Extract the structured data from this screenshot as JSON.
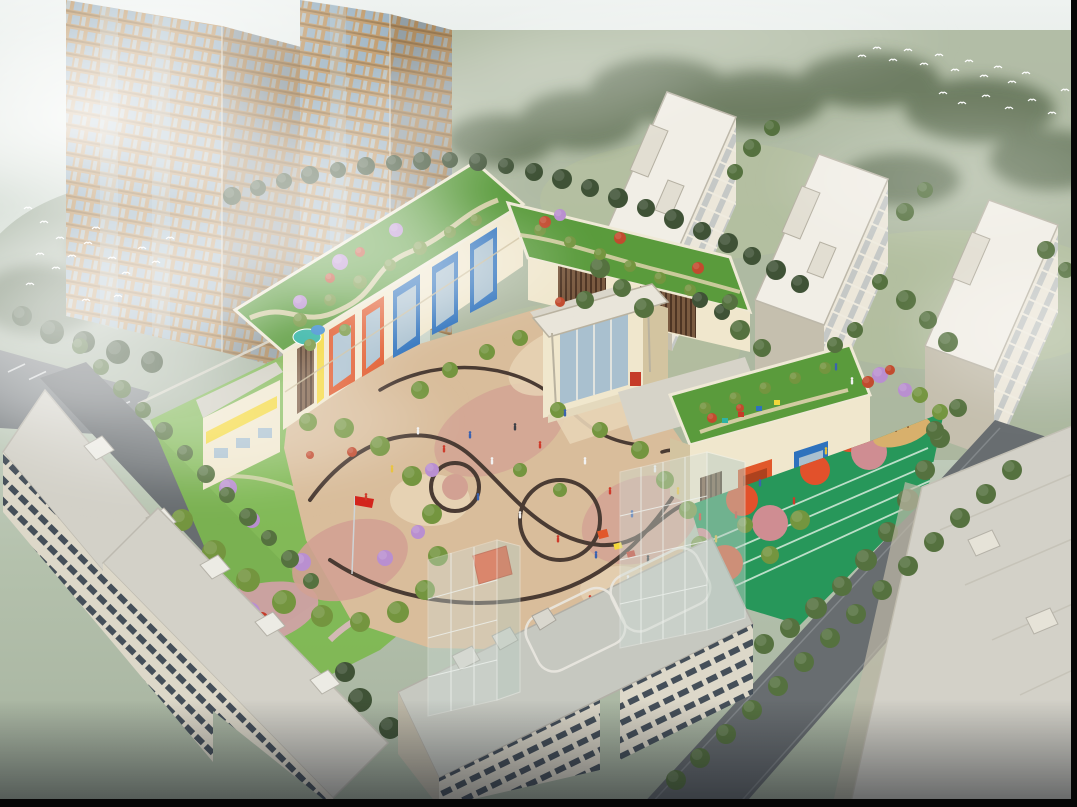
{
  "meta": {
    "type": "architectural aerial rendering",
    "subject": "bird's-eye view of a three-storey kindergarten campus with planted green roofs, a curved-pattern paved courtyard, a rooftop running-track playground and a red flag, surrounded by residential apartment towers and slab blocks in soft morning mist; flocks of white birds; tree-lined streets",
    "width": 1077,
    "height": 807,
    "visible_text": "none"
  },
  "scene": {
    "towers": {
      "label": "twin high-rise residential towers veiled in mist",
      "count": 2
    },
    "midrises": {
      "label": "cream mid-rise apartment blocks on lawn",
      "count": 3
    },
    "kindergarten": {
      "label": "kindergarten complex",
      "features": [
        "green roof gardens",
        "colourful window bays",
        "entrance pavilion with canopy",
        "curved courtyard paving",
        "rooftop track playground",
        "red flag on pole",
        "play equipment",
        "purple blossom trees"
      ]
    },
    "foreground": {
      "label": "low-rise apartment slabs in foreground",
      "count": 4
    },
    "roads": {
      "label": "tree-lined streets and parking strip"
    },
    "glass_buildings": {
      "label": "translucent glazed volumes",
      "count": 2
    },
    "birds": {
      "label": "flocks of white birds",
      "count": 35
    },
    "people": {
      "label": "tiny figures on plaza and playground",
      "count": 30
    }
  },
  "palette": {
    "frame": "#060606",
    "sky_top": "#eef2f0",
    "sky_mid": "#ccd6cb",
    "sky_low": "#b4c1ac",
    "sky_bot": "#a5b19e",
    "ground": "#a8b49a",
    "ground_dark": "#8d9c85",
    "ground_light": "#b8c49e",
    "tree_dark": "#3f5236",
    "tree_mid": "#55713f",
    "tree_bright": "#74953f",
    "blossom_purple": "#b98fd0",
    "shrub_red": "#c24b2e",
    "mist": "#ffffff",
    "tower_wall": "#c09a6a",
    "tower_wall_dark": "#a07e52",
    "tower_glass": "#9db3c2",
    "mid_wall": "#ece7da",
    "mid_wall_shade": "#c5bfae",
    "mid_roof": "#f1eee6",
    "mid_window": "#7d8ea0",
    "k_wall": "#f0e7cd",
    "k_wall_shade": "#d3c4a0",
    "k_blue": "#2e72bd",
    "k_orange": "#e1582a",
    "k_yellow": "#f4d83a",
    "k_red": "#c53b28",
    "louver": "#7a5a40",
    "louver_dark": "#4e3524",
    "glassy": "#a9c0cf",
    "roof_green": "#5a9b3c",
    "lawn": "#7cb84e",
    "roof_path": "#ded2ac",
    "pool_teal": "#2fb3a4",
    "pool_blue": "#3e8ed0",
    "plaza_tan": "#d9bd9b",
    "plaza_pink": "#d2a193",
    "plaza_light": "#e7d4b6",
    "plaza_line": "#4a3b33",
    "track_green": "#27975a",
    "track_lane": "#d8ecdd",
    "play_orange": "#e2512b",
    "play_pink": "#cf8d92",
    "sand": "#d8b06c",
    "road": "#686d70",
    "road_light": "#8d9295",
    "fg_roof": "#d3d1c8",
    "fg_roof2": "#c6c8c0",
    "fg_wall": "#ddd8c9",
    "fg_wall_shade": "#bfb9a8",
    "fg_window": "#454f59",
    "glass_box": "#cfdcd6",
    "glass_frame": "#eef2ee",
    "wall_light": "#d8d5c8",
    "flag_red": "#d3251c",
    "bird": "#ffffff",
    "people_colors": {
      "w": "#f2f2f2",
      "r": "#cf3a2a",
      "b": "#3a62b0",
      "y": "#e8c23a",
      "k": "#3c3f45"
    }
  },
  "trees": {
    "dark": [
      [
        232,
        196,
        9
      ],
      [
        258,
        188,
        8
      ],
      [
        284,
        181,
        8
      ],
      [
        310,
        175,
        9
      ],
      [
        338,
        170,
        8
      ],
      [
        366,
        166,
        9
      ],
      [
        394,
        163,
        8
      ],
      [
        422,
        161,
        9
      ],
      [
        450,
        160,
        8
      ],
      [
        478,
        162,
        9
      ],
      [
        506,
        166,
        8
      ],
      [
        534,
        172,
        9
      ],
      [
        562,
        179,
        10
      ],
      [
        590,
        188,
        9
      ],
      [
        618,
        198,
        10
      ],
      [
        646,
        208,
        9
      ],
      [
        674,
        219,
        10
      ],
      [
        702,
        231,
        9
      ],
      [
        728,
        243,
        10
      ],
      [
        752,
        256,
        9
      ],
      [
        776,
        270,
        10
      ],
      [
        800,
        284,
        9
      ],
      [
        52,
        332,
        12
      ],
      [
        84,
        342,
        11
      ],
      [
        118,
        352,
        12
      ],
      [
        152,
        362,
        11
      ],
      [
        22,
        316,
        10
      ],
      [
        360,
        700,
        12
      ],
      [
        390,
        728,
        11
      ],
      [
        345,
        672,
        10
      ],
      [
        560,
        655,
        9
      ],
      [
        588,
        668,
        9
      ],
      [
        616,
        680,
        9
      ],
      [
        700,
        300,
        8
      ],
      [
        722,
        312,
        8
      ]
    ],
    "mid": [
      [
        600,
        268,
        10
      ],
      [
        622,
        288,
        9
      ],
      [
        644,
        308,
        10
      ],
      [
        585,
        300,
        9
      ],
      [
        740,
        330,
        10
      ],
      [
        762,
        348,
        9
      ],
      [
        730,
        302,
        8
      ],
      [
        906,
        300,
        10
      ],
      [
        928,
        320,
        9
      ],
      [
        948,
        342,
        10
      ],
      [
        880,
        282,
        8
      ],
      [
        752,
        148,
        9
      ],
      [
        772,
        128,
        8
      ],
      [
        735,
        172,
        8
      ],
      [
        905,
        212,
        9
      ],
      [
        925,
        190,
        8
      ],
      [
        1046,
        250,
        9
      ],
      [
        1066,
        270,
        8
      ],
      [
        940,
        438,
        10
      ],
      [
        925,
        470,
        10
      ],
      [
        908,
        500,
        11
      ],
      [
        888,
        532,
        10
      ],
      [
        866,
        560,
        11
      ],
      [
        842,
        586,
        10
      ],
      [
        816,
        608,
        11
      ],
      [
        790,
        628,
        10
      ],
      [
        764,
        644,
        10
      ],
      [
        958,
        408,
        9
      ],
      [
        935,
        430,
        9
      ],
      [
        855,
        330,
        8
      ],
      [
        835,
        345,
        8
      ]
    ],
    "front": [
      [
        1012,
        470,
        10
      ],
      [
        986,
        494,
        10
      ],
      [
        960,
        518,
        10
      ],
      [
        934,
        542,
        10
      ],
      [
        908,
        566,
        10
      ],
      [
        882,
        590,
        10
      ],
      [
        856,
        614,
        10
      ],
      [
        830,
        638,
        10
      ],
      [
        804,
        662,
        10
      ],
      [
        778,
        686,
        10
      ],
      [
        752,
        710,
        10
      ],
      [
        726,
        734,
        10
      ],
      [
        700,
        758,
        10
      ],
      [
        676,
        780,
        10
      ],
      [
        80,
        346,
        8
      ],
      [
        101,
        367,
        8
      ],
      [
        122,
        389,
        9
      ],
      [
        143,
        410,
        8
      ],
      [
        164,
        431,
        9
      ],
      [
        185,
        453,
        8
      ],
      [
        206,
        474,
        9
      ],
      [
        227,
        495,
        8
      ],
      [
        248,
        517,
        9
      ],
      [
        269,
        538,
        8
      ],
      [
        290,
        559,
        9
      ],
      [
        311,
        581,
        8
      ]
    ],
    "bright": [
      [
        182,
        520,
        11
      ],
      [
        214,
        552,
        12
      ],
      [
        248,
        580,
        12
      ],
      [
        284,
        602,
        12
      ],
      [
        322,
        616,
        11
      ],
      [
        360,
        622,
        10
      ],
      [
        398,
        612,
        11
      ],
      [
        425,
        590,
        10
      ],
      [
        438,
        556,
        10
      ],
      [
        432,
        514,
        10
      ],
      [
        412,
        476,
        10
      ],
      [
        380,
        446,
        10
      ],
      [
        344,
        428,
        10
      ],
      [
        308,
        422,
        9
      ],
      [
        300,
        320,
        7
      ],
      [
        330,
        300,
        6
      ],
      [
        360,
        282,
        7
      ],
      [
        390,
        265,
        6
      ],
      [
        420,
        248,
        7
      ],
      [
        450,
        232,
        6
      ],
      [
        476,
        220,
        6
      ],
      [
        310,
        345,
        6
      ],
      [
        345,
        330,
        6
      ],
      [
        540,
        230,
        6
      ],
      [
        570,
        242,
        6
      ],
      [
        600,
        254,
        6
      ],
      [
        630,
        266,
        6
      ],
      [
        660,
        278,
        6
      ],
      [
        690,
        290,
        6
      ],
      [
        705,
        408,
        6
      ],
      [
        735,
        398,
        6
      ],
      [
        765,
        388,
        6
      ],
      [
        795,
        378,
        6
      ],
      [
        825,
        368,
        6
      ],
      [
        420,
        390,
        9
      ],
      [
        450,
        370,
        8
      ],
      [
        487,
        352,
        8
      ],
      [
        520,
        338,
        8
      ],
      [
        558,
        410,
        8
      ],
      [
        600,
        430,
        8
      ],
      [
        640,
        450,
        9
      ],
      [
        665,
        480,
        9
      ],
      [
        688,
        510,
        9
      ],
      [
        700,
        545,
        9
      ],
      [
        520,
        470,
        7
      ],
      [
        560,
        490,
        7
      ],
      [
        800,
        520,
        10
      ],
      [
        770,
        555,
        9
      ],
      [
        745,
        525,
        8
      ],
      [
        920,
        395,
        8
      ],
      [
        940,
        412,
        8
      ]
    ],
    "purple": [
      [
        340,
        262,
        8
      ],
      [
        396,
        230,
        7
      ],
      [
        300,
        302,
        7
      ],
      [
        228,
        488,
        9
      ],
      [
        206,
        584,
        10
      ],
      [
        250,
        612,
        10
      ],
      [
        302,
        562,
        9
      ],
      [
        385,
        558,
        8
      ],
      [
        418,
        532,
        7
      ],
      [
        560,
        215,
        6
      ],
      [
        880,
        375,
        8
      ],
      [
        905,
        390,
        7
      ],
      [
        432,
        470,
        7
      ],
      [
        252,
        520,
        8
      ]
    ],
    "red": [
      [
        545,
        222,
        6
      ],
      [
        620,
        238,
        6
      ],
      [
        698,
        268,
        6
      ],
      [
        360,
        252,
        5
      ],
      [
        330,
        278,
        5
      ],
      [
        868,
        382,
        6
      ],
      [
        890,
        370,
        5
      ],
      [
        712,
        418,
        5
      ],
      [
        740,
        408,
        4
      ],
      [
        352,
        452,
        5
      ],
      [
        310,
        455,
        4
      ],
      [
        560,
        302,
        5
      ]
    ]
  },
  "birds": [
    [
      862,
      56
    ],
    [
      877,
      48
    ],
    [
      893,
      60
    ],
    [
      908,
      50
    ],
    [
      924,
      64
    ],
    [
      939,
      55
    ],
    [
      955,
      70
    ],
    [
      969,
      61
    ],
    [
      984,
      76
    ],
    [
      998,
      67
    ],
    [
      1012,
      82
    ],
    [
      1026,
      73
    ],
    [
      943,
      93
    ],
    [
      962,
      103
    ],
    [
      986,
      96
    ],
    [
      1009,
      108
    ],
    [
      1032,
      100
    ],
    [
      1052,
      113
    ],
    [
      1065,
      90
    ],
    [
      28,
      208
    ],
    [
      44,
      222
    ],
    [
      60,
      238
    ],
    [
      40,
      254
    ],
    [
      56,
      268
    ],
    [
      72,
      256
    ],
    [
      88,
      243
    ],
    [
      30,
      284
    ],
    [
      96,
      228
    ],
    [
      112,
      258
    ],
    [
      126,
      273
    ],
    [
      142,
      248
    ],
    [
      156,
      262
    ],
    [
      170,
      238
    ],
    [
      118,
      296
    ],
    [
      86,
      300
    ]
  ],
  "people": [
    [
      418,
      432,
      "w"
    ],
    [
      444,
      450,
      "r"
    ],
    [
      470,
      436,
      "b"
    ],
    [
      492,
      462,
      "w"
    ],
    [
      515,
      428,
      "k"
    ],
    [
      540,
      446,
      "r"
    ],
    [
      565,
      414,
      "b"
    ],
    [
      585,
      462,
      "w"
    ],
    [
      610,
      492,
      "r"
    ],
    [
      632,
      515,
      "b"
    ],
    [
      655,
      470,
      "w"
    ],
    [
      678,
      492,
      "y"
    ],
    [
      700,
      518,
      "r"
    ],
    [
      478,
      498,
      "b"
    ],
    [
      520,
      516,
      "w"
    ],
    [
      558,
      540,
      "r"
    ],
    [
      596,
      556,
      "b"
    ],
    [
      628,
      580,
      "w"
    ],
    [
      392,
      470,
      "y"
    ],
    [
      366,
      498,
      "r"
    ],
    [
      836,
      368,
      "b"
    ],
    [
      852,
      382,
      "w"
    ],
    [
      716,
      540,
      "y"
    ],
    [
      736,
      516,
      "r"
    ],
    [
      760,
      484,
      "b"
    ],
    [
      700,
      572,
      "w"
    ],
    [
      794,
      502,
      "r"
    ],
    [
      826,
      452,
      "y"
    ],
    [
      648,
      560,
      "k"
    ],
    [
      590,
      600,
      "r"
    ]
  ],
  "parking": {
    "x": 8,
    "y": 372,
    "dx": 21,
    "dy": 7.5,
    "len": 17,
    "drop": -8,
    "count": 7
  }
}
